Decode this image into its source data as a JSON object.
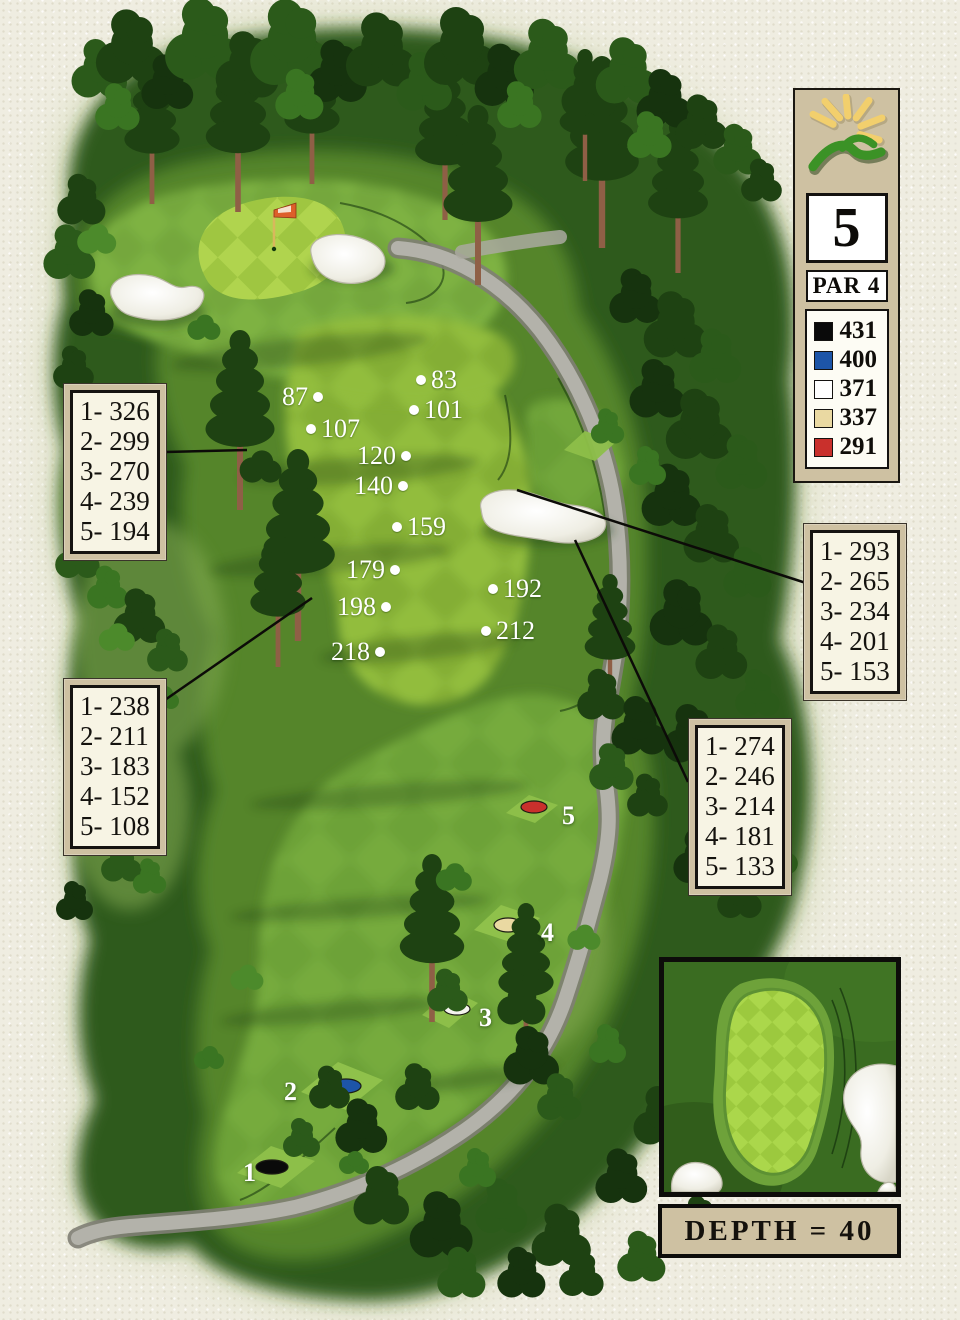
{
  "panel": {
    "hole_number": "5",
    "par_label": "PAR 4",
    "logo": "sun-mountain-logo",
    "tee_legend": [
      {
        "name": "black",
        "hex": "#0a0a0a",
        "yards": "431"
      },
      {
        "name": "blue",
        "hex": "#1d55a8",
        "yards": "400"
      },
      {
        "name": "white",
        "hex": "#ffffff",
        "yards": "371"
      },
      {
        "name": "gold",
        "hex": "#ead9a2",
        "yards": "337"
      },
      {
        "name": "red",
        "hex": "#c9302c",
        "yards": "291"
      }
    ]
  },
  "yardage_boxes": [
    {
      "position": "upper-left",
      "rows": [
        "1- 326",
        "2- 299",
        "3- 270",
        "4- 239",
        "5- 194"
      ]
    },
    {
      "position": "upper-right",
      "rows": [
        "1- 293",
        "2- 265",
        "3- 234",
        "4- 201",
        "5- 153"
      ]
    },
    {
      "position": "lower-left",
      "rows": [
        "1- 238",
        "2- 211",
        "3- 183",
        "4- 152",
        "5- 108"
      ]
    },
    {
      "position": "lower-right",
      "rows": [
        "1- 274",
        "2- 246",
        "3- 214",
        "4- 181",
        "5- 133"
      ]
    }
  ],
  "distance_markers": [
    {
      "value": "83",
      "dot_side": "left"
    },
    {
      "value": "101",
      "dot_side": "left"
    },
    {
      "value": "87",
      "dot_side": "right"
    },
    {
      "value": "107",
      "dot_side": "left"
    },
    {
      "value": "120",
      "dot_side": "right"
    },
    {
      "value": "140",
      "dot_side": "right"
    },
    {
      "value": "159",
      "dot_side": "left"
    },
    {
      "value": "179",
      "dot_side": "right"
    },
    {
      "value": "192",
      "dot_side": "left"
    },
    {
      "value": "198",
      "dot_side": "right"
    },
    {
      "value": "212",
      "dot_side": "left"
    },
    {
      "value": "218",
      "dot_side": "right"
    }
  ],
  "tee_boxes": [
    {
      "number": "1",
      "color": "black",
      "hex": "#0a0a0a"
    },
    {
      "number": "2",
      "color": "blue",
      "hex": "#1d55a8"
    },
    {
      "number": "3",
      "color": "white",
      "hex": "#f4f4ee"
    },
    {
      "number": "4",
      "color": "gold",
      "hex": "#ead9a2"
    },
    {
      "number": "5",
      "color": "red",
      "hex": "#c9302c"
    }
  ],
  "green_inset": {
    "depth_label": "DEPTH = 40"
  },
  "colors": {
    "fairway_light": "#92bd3d",
    "fairway_dark": "#84ae36",
    "green_light": "#b0d44e",
    "green_dark": "#9fc641",
    "rough": "#55852c",
    "forest": "#2e5a1c",
    "bunker": "#f5f4ec",
    "cart_path": "#b3b2aa",
    "panel_tan": "#cec1a2"
  }
}
